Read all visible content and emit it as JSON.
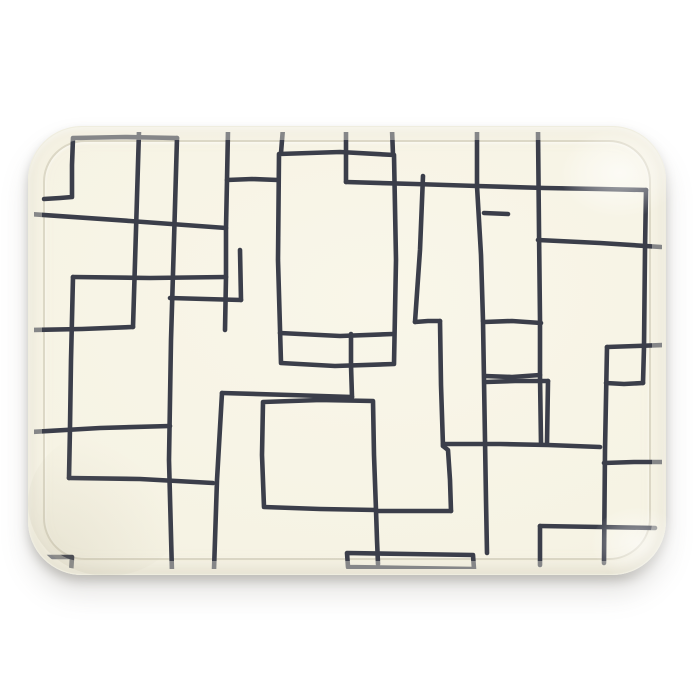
{
  "scene": {
    "type": "product-photo",
    "description": "Cream rectangular serving tray with rounded corners, decorated with a hand-drawn pattern of overlapping dark rectangle outlines, photographed straight-on against a plain white background with a soft shadow beneath the tray",
    "background_color": "#ffffff"
  },
  "tray": {
    "shape": "rounded-rectangle",
    "surface_color": "#f6f3e4",
    "surface_edge_color": "#edeada",
    "crease_color": "rgba(162,155,131,0.30)",
    "rim_wash_color": "rgba(246,243,229,0.40)",
    "shadow_color": "rgba(110,106,96,0.32)"
  },
  "pattern": {
    "description": "overlapping freehand rectangle outlines",
    "stroke_color": "#3b3e4a",
    "stroke_width": 4.6,
    "clip": {
      "x": 34,
      "y": 132,
      "width": 628,
      "height": 437,
      "radius": 46
    },
    "strokes": [
      [
        [
          44,
          199
        ],
        [
          60,
          198
        ],
        [
          72,
          197
        ],
        [
          72,
          165
        ],
        [
          73,
          138
        ],
        [
          125,
          137
        ],
        [
          177,
          138
        ]
      ],
      [
        [
          177,
          138
        ],
        [
          174,
          240
        ],
        [
          171,
          340
        ],
        [
          169,
          460
        ],
        [
          172,
          573
        ]
      ],
      [
        [
          44,
          557
        ],
        [
          58,
          557
        ],
        [
          72,
          557
        ],
        [
          71,
          573
        ]
      ],
      [
        [
          30,
          214
        ],
        [
          130,
          221
        ],
        [
          226,
          228
        ]
      ],
      [
        [
          228,
          130
        ],
        [
          227,
          180
        ],
        [
          226,
          228
        ],
        [
          226,
          277
        ],
        [
          225,
          330
        ]
      ],
      [
        [
          227,
          180
        ],
        [
          252,
          179
        ],
        [
          278,
          180
        ]
      ],
      [
        [
          226,
          277
        ],
        [
          150,
          278
        ],
        [
          73,
          277
        ]
      ],
      [
        [
          73,
          277
        ],
        [
          71,
          360
        ],
        [
          70,
          427
        ],
        [
          69,
          478
        ]
      ],
      [
        [
          139,
          131
        ],
        [
          136,
          230
        ],
        [
          133,
          327
        ]
      ],
      [
        [
          133,
          327
        ],
        [
          82,
          329
        ],
        [
          30,
          330
        ]
      ],
      [
        [
          30,
          432
        ],
        [
          100,
          428
        ],
        [
          170,
          426
        ]
      ],
      [
        [
          69,
          478
        ],
        [
          140,
          479
        ],
        [
          213,
          483
        ]
      ],
      [
        [
          170,
          298
        ],
        [
          205,
          299
        ],
        [
          241,
          300
        ]
      ],
      [
        [
          241,
          300
        ],
        [
          240,
          250
        ]
      ],
      [
        [
          283,
          128
        ],
        [
          281,
          153
        ]
      ],
      [
        [
          392,
          129
        ],
        [
          393,
          155
        ]
      ],
      [
        [
          279,
          154
        ],
        [
          340,
          152
        ],
        [
          394,
          155
        ],
        [
          396,
          260
        ],
        [
          394,
          364
        ],
        [
          335,
          366
        ],
        [
          281,
          363
        ],
        [
          278,
          260
        ],
        [
          279,
          154
        ]
      ],
      [
        [
          280,
          333
        ],
        [
          340,
          336
        ],
        [
          393,
          334
        ]
      ],
      [
        [
          346,
          130
        ],
        [
          346,
          182
        ]
      ],
      [
        [
          346,
          182
        ],
        [
          415,
          184
        ],
        [
          477,
          186
        ],
        [
          545,
          188
        ],
        [
          600,
          189
        ],
        [
          646,
          190
        ]
      ],
      [
        [
          477,
          130
        ],
        [
          477,
          186
        ]
      ],
      [
        [
          477,
          186
        ],
        [
          481,
          255
        ],
        [
          483,
          321
        ]
      ],
      [
        [
          484,
          213
        ],
        [
          508,
          214
        ]
      ],
      [
        [
          483,
          321
        ],
        [
          484,
          380
        ],
        [
          485,
          440
        ],
        [
          486,
          500
        ],
        [
          487,
          553
        ]
      ],
      [
        [
          484,
          322
        ],
        [
          512,
          321
        ],
        [
          541,
          323
        ]
      ],
      [
        [
          540,
          375
        ],
        [
          512,
          377
        ],
        [
          485,
          376
        ]
      ],
      [
        [
          538,
          130
        ],
        [
          539,
          230
        ],
        [
          540,
          320
        ],
        [
          540,
          376
        ],
        [
          541,
          443
        ]
      ],
      [
        [
          646,
          190
        ],
        [
          645,
          250
        ],
        [
          644,
          347
        ],
        [
          643,
          383
        ]
      ],
      [
        [
          643,
          383
        ],
        [
          624,
          384
        ],
        [
          606,
          383
        ]
      ],
      [
        [
          538,
          240
        ],
        [
          600,
          243
        ],
        [
          661,
          247
        ]
      ],
      [
        [
          423,
          176
        ],
        [
          420,
          250
        ],
        [
          415,
          322
        ]
      ],
      [
        [
          415,
          322
        ],
        [
          428,
          321
        ],
        [
          440,
          321
        ]
      ],
      [
        [
          440,
          321
        ],
        [
          441,
          385
        ],
        [
          443,
          446
        ]
      ],
      [
        [
          443,
          446
        ],
        [
          448,
          450
        ],
        [
          450,
          480
        ],
        [
          451,
          511
        ]
      ],
      [
        [
          443,
          444
        ],
        [
          500,
          444
        ],
        [
          548,
          445
        ],
        [
          600,
          447
        ]
      ],
      [
        [
          263,
          402
        ],
        [
          320,
          400
        ],
        [
          373,
          401
        ],
        [
          374,
          455
        ],
        [
          376,
          510
        ],
        [
          320,
          509
        ],
        [
          264,
          507
        ],
        [
          262,
          455
        ],
        [
          263,
          402
        ]
      ],
      [
        [
          376,
          510
        ],
        [
          377,
          540
        ],
        [
          378,
          564
        ]
      ],
      [
        [
          376,
          511
        ],
        [
          415,
          511
        ],
        [
          451,
          511
        ]
      ],
      [
        [
          222,
          393
        ],
        [
          290,
          395
        ],
        [
          352,
          397
        ]
      ],
      [
        [
          352,
          397
        ],
        [
          351,
          365
        ],
        [
          351,
          334
        ]
      ],
      [
        [
          222,
          393
        ],
        [
          217,
          480
        ],
        [
          214,
          570
        ]
      ],
      [
        [
          347,
          553
        ],
        [
          410,
          554
        ],
        [
          473,
          555
        ],
        [
          474,
          569
        ],
        [
          410,
          568
        ],
        [
          348,
          567
        ],
        [
          347,
          553
        ]
      ],
      [
        [
          486,
          382
        ],
        [
          515,
          381
        ],
        [
          548,
          381
        ]
      ],
      [
        [
          548,
          381
        ],
        [
          547,
          444
        ]
      ],
      [
        [
          607,
          347
        ],
        [
          636,
          346
        ],
        [
          664,
          345
        ]
      ],
      [
        [
          607,
          347
        ],
        [
          605,
          450
        ],
        [
          604,
          563
        ]
      ],
      [
        [
          604,
          463
        ],
        [
          634,
          462
        ],
        [
          664,
          462
        ]
      ],
      [
        [
          540,
          526
        ],
        [
          600,
          527
        ],
        [
          655,
          528
        ]
      ],
      [
        [
          540,
          526
        ],
        [
          540,
          565
        ]
      ]
    ]
  }
}
